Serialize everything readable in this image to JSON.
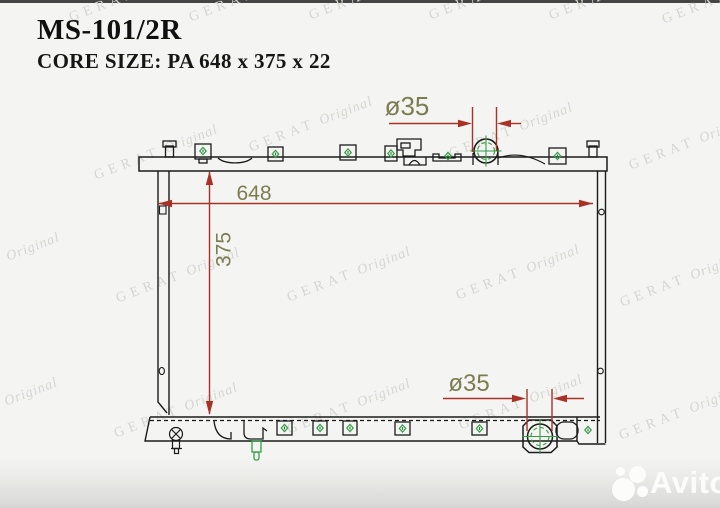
{
  "header": {
    "part_number": "MS-101/2R",
    "core_size": "CORE SIZE: PA 648 x 375 x 22"
  },
  "dimensions": {
    "width": "648",
    "height": "375",
    "top_pipe": "ø35",
    "bottom_pipe": "ø35"
  },
  "watermark": {
    "brand": "GERAT",
    "suffix": "Original"
  },
  "footer": {
    "logo_text": "Avito"
  },
  "colors": {
    "drawing_line": "#1b1b1b",
    "dimension_line": "#a93226",
    "dimension_text": "#7d7d52",
    "fitting_green": "#2f9e44",
    "watermark": "#d5d5d1",
    "footer_strip": "#dcdcda"
  }
}
